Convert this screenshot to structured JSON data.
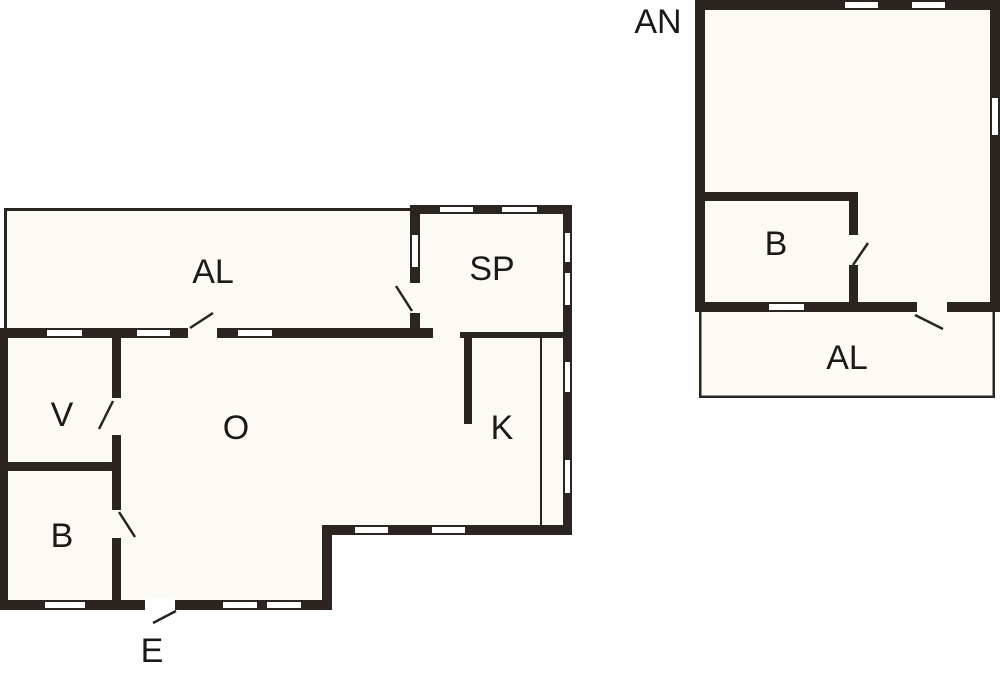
{
  "document": {
    "type": "floor-plan",
    "background_color": "#ffffff",
    "wall_color": "#2b2420",
    "floor_color": "#fbfaf4",
    "label_color": "#1c1916"
  },
  "main_building": {
    "rooms": [
      {
        "id": "al_terrace",
        "label": "AL"
      },
      {
        "id": "sp",
        "label": "SP"
      },
      {
        "id": "v",
        "label": "V"
      },
      {
        "id": "o",
        "label": "O"
      },
      {
        "id": "k",
        "label": "K"
      },
      {
        "id": "b",
        "label": "B"
      }
    ],
    "entrance": {
      "label": "E"
    }
  },
  "annex": {
    "title": "AN",
    "rooms": [
      {
        "id": "b",
        "label": "B"
      },
      {
        "id": "al_terrace",
        "label": "AL"
      }
    ]
  },
  "labels": {
    "al_main": "AL",
    "sp": "SP",
    "v": "V",
    "o": "O",
    "k": "K",
    "b_main": "B",
    "e": "E",
    "an": "AN",
    "b_annex": "B",
    "al_annex": "AL"
  }
}
